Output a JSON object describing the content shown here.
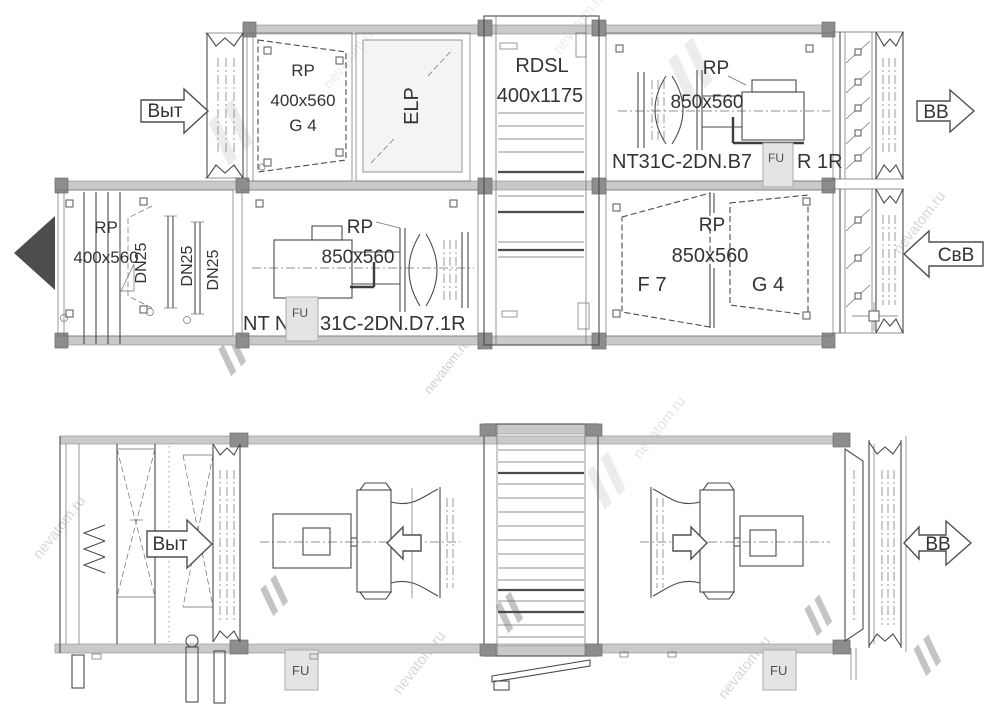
{
  "watermark": {
    "brand": "nevatom.ru"
  },
  "plan": {
    "arrow_vyt": "Выт",
    "arrow_vv": "ВВ",
    "arrow_svv": "СвВ",
    "filter_g4": {
      "code": "RP",
      "size": "400x560",
      "grade": "G 4"
    },
    "elp": {
      "label": "ELP"
    },
    "louver": {
      "code": "RDSL",
      "size": "400x1175"
    },
    "fan_b7": {
      "code": "RP",
      "size": "850x560",
      "model_left": "NT31C-2DN.B7",
      "fu": "FU",
      "model_right": "R 1R"
    },
    "filter_400": {
      "code": "RP",
      "size": "400x560"
    },
    "dn25": [
      "DN25",
      "DN25",
      "DN25"
    ],
    "fan_d7": {
      "code": "RP",
      "size": "850x560",
      "model_left": "NT N",
      "fu": "FU",
      "model_right": "31C-2DN.D7.1R"
    },
    "filter_f7g4": {
      "code": "RP",
      "size": "850x560",
      "grade_left": "F 7",
      "grade_right": "G 4"
    }
  },
  "side": {
    "arrow_vyt": "Выт",
    "arrow_vv": "ВВ",
    "fu_left": "FU",
    "fu_right": "FU"
  }
}
